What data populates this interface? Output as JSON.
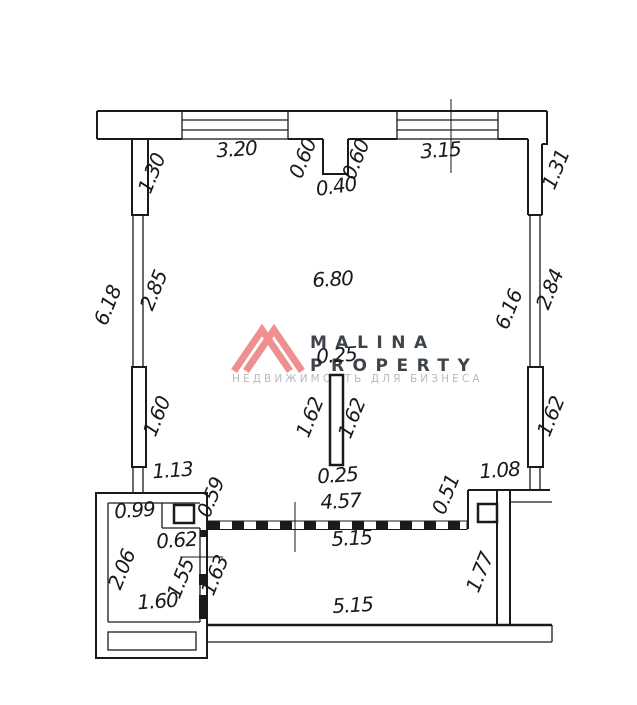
{
  "watermark": {
    "line1": "MALINA",
    "line2": "PROPERTY",
    "tagline": "НЕДВИЖИМОСТЬ ДЛЯ БИЗНЕСА",
    "logo_color": "#ef8f8f",
    "text_color": "#3e444c",
    "tagline_color": "#b7babe"
  },
  "plan": {
    "line_color": "#1a1a1a",
    "dimensions": {
      "win_top_left": "3.20",
      "niche_left": "0.60",
      "niche_right": "0.60",
      "niche_width": "0.40",
      "win_top_right": "3.15",
      "wall_left_top": "1.30",
      "wall_right_top": "1.31",
      "left_outer": "6.18",
      "left_inner": "2.85",
      "right_inner": "6.16",
      "right_outer": "2.84",
      "room_width": "6.80",
      "column_top": "0.25",
      "column_left": "1.62",
      "column_right": "1.62",
      "wall_left_mid": "1.60",
      "wall_right_mid": "1.62",
      "column_bottom": "0.25",
      "left_lower": "1.13",
      "partition_left_offset": "0.59",
      "partition_top": "4.57",
      "partition_right_offset": "0.51",
      "right_lower": "1.08",
      "partition_bottom": "5.15",
      "small_room_top": "0.99",
      "shaft_offset": "0.62",
      "small_room_left": "2.06",
      "small_room_inner": "1.55",
      "corridor_height": "1.63",
      "lower_wall": "1.77",
      "small_room_bottom": "1.60",
      "bottom_room_width": "5.15"
    }
  }
}
